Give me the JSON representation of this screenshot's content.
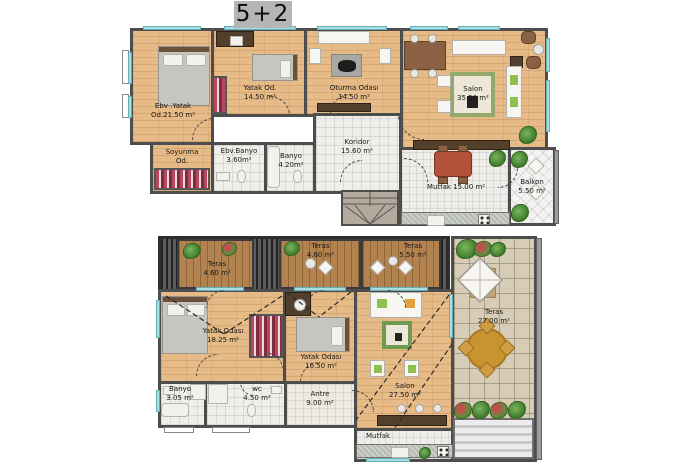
{
  "title": "5+2",
  "upper": {
    "ebv_yatak": {
      "l1": "Ebv .Yatak",
      "l2": "Od.21.50 m²"
    },
    "yatak": {
      "l1": "Yatak Od.",
      "l2": "14.50 m²"
    },
    "oturma": {
      "l1": "Oturma Odası",
      "l2": "14.50 m²"
    },
    "salon": {
      "l1": "Salon",
      "l2": "35.50 m²"
    },
    "soyunma": {
      "l1": "Soyunma",
      "l2": "Od."
    },
    "ebv_banyo": {
      "l1": "Ebv.Banyo",
      "l2": "3.60m²"
    },
    "banyo": {
      "l1": "Banyo",
      "l2": "4.20m²"
    },
    "koridor": {
      "l1": "Koridor",
      "l2": "15.60 m²"
    },
    "mutfak": {
      "l1": "Mutfak 15.00 m²"
    },
    "balkon": {
      "l1": "Balkon",
      "l2": "5.50 m²"
    }
  },
  "lower": {
    "teras1": {
      "l1": "Teras",
      "l2": "4.60 m²"
    },
    "teras2": {
      "l1": "Teras",
      "l2": "4.60 m²"
    },
    "teras3": {
      "l1": "Teras",
      "l2": "5.50 m²"
    },
    "yatak1": {
      "l1": "Yatak Odası",
      "l2": "18.25 m²"
    },
    "yatak2": {
      "l1": "Yatak Odası",
      "l2": "10.50 m²"
    },
    "banyo": {
      "l1": "Banyo",
      "l2": "3.05 m²"
    },
    "wc": {
      "l1": "wc",
      "l2": "4.50 m²"
    },
    "antre": {
      "l1": "Antre",
      "l2": "9.00 m²"
    },
    "salon": {
      "l1": "Salon",
      "l2": "27.50 m²"
    },
    "mutfak": {
      "l1": "Mutfak"
    },
    "teras_big": {
      "l1": "Teras",
      "l2": "27.00 m²"
    }
  },
  "colors": {
    "wall": "#4d4d4d",
    "wood_floor": "#e6bb87",
    "deck_wood": "#b2834f",
    "tile": "#f1efec",
    "terrace_tile": "#d7ccb6",
    "window": "#a9dde2",
    "title_bg": "#b5b5b5",
    "plant": "#4e8f3c"
  }
}
